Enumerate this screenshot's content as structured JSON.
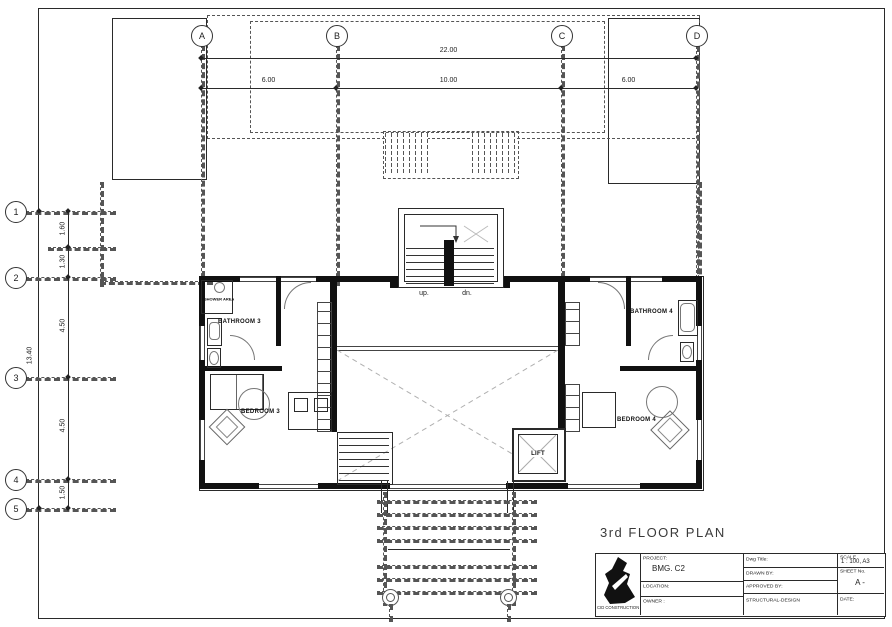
{
  "sheet": {
    "plan_title": "3rd FLOOR PLAN"
  },
  "grid": {
    "col_bubbles": [
      "A",
      "B",
      "C",
      "D"
    ],
    "row_bubbles": [
      "1",
      "2",
      "3",
      "4",
      "5"
    ],
    "top_overall": "22.00",
    "top_segments": [
      "6.00",
      "10.00",
      "6.00"
    ],
    "left_overall": "13.40",
    "left_segments": [
      "1.60",
      "1.30",
      "4.50",
      "4.50",
      "1.50"
    ]
  },
  "plan": {
    "bathroom3": "BATHROOM 3",
    "bedroom3": "BEDROOM 3",
    "bathroom4": "BATHROOM 4",
    "bedroom4": "BEDROOM 4",
    "lift": "LIFT",
    "up": "up.",
    "dn": "dn.",
    "shower_label": "SHOWER AREA"
  },
  "titleblock": {
    "logo_text": "CID CONSTRUCTION",
    "project_label": "PROJECT:",
    "project_value": "BMG. C2",
    "location_label": "LOCATION:",
    "owner_label": "OWNER :",
    "dwg_title_label": "Dwg Title:",
    "drawn_by_label": "DRAWN BY:",
    "approved_label": "APPROVED BY:",
    "structural_label": "STRUCTURAL-DESIGN",
    "scale_label": "SCALE",
    "scale_value": "1 : 100, A3",
    "sheet_no_label": "SHEET No.",
    "sheet_no_value": "A -",
    "date_label": "DATE:"
  }
}
